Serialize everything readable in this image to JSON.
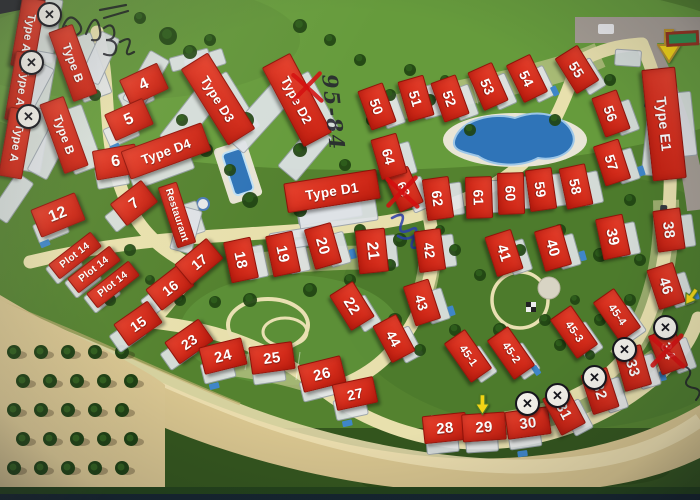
{
  "map": {
    "description": "Aerial resort master plan (photographed print) with numbered plot labels",
    "palette": {
      "label_red": "#d42c1b",
      "label_text": "#ffffff",
      "grass": "#567f36",
      "road_cream": "#e8e0ad",
      "road_gray": "#a59d94",
      "sand": "#d7c48e",
      "pool_blue": "#2f74b8",
      "tree_green": "#1f4312",
      "sign_green": "#2f8f4e",
      "arrow_yellow": "#f2d416",
      "pen_ink": "#14141c",
      "pen_blue": "#2b3fae",
      "pen_red": "#d40f0f"
    },
    "plots": [
      {
        "label": "Type A",
        "kind": "type",
        "x": 27,
        "y": 32,
        "rot": 100,
        "w": 68,
        "h": 22,
        "font": 11.5
      },
      {
        "label": "Type A",
        "kind": "type",
        "x": 21,
        "y": 86,
        "rot": 100,
        "w": 68,
        "h": 22,
        "font": 11.5
      },
      {
        "label": "Type A",
        "kind": "type",
        "x": 15,
        "y": 142,
        "rot": 100,
        "w": 68,
        "h": 22,
        "font": 11.5
      },
      {
        "label": "Type B",
        "kind": "type",
        "x": 72,
        "y": 62,
        "rot": 70,
        "w": 72,
        "h": 24,
        "font": 12
      },
      {
        "label": "Type B",
        "kind": "type",
        "x": 63,
        "y": 134,
        "rot": 70,
        "w": 72,
        "h": 24,
        "font": 12
      },
      {
        "label": "4",
        "kind": "num",
        "x": 143,
        "y": 83,
        "rot": -25,
        "w": 40,
        "h": 27,
        "font": 16
      },
      {
        "label": "5",
        "kind": "num",
        "x": 128,
        "y": 118,
        "rot": -24,
        "w": 40,
        "h": 27,
        "font": 16
      },
      {
        "label": "6",
        "kind": "num",
        "x": 115,
        "y": 161,
        "rot": -10,
        "w": 42,
        "h": 28,
        "font": 16
      },
      {
        "label": "7",
        "kind": "num",
        "x": 133,
        "y": 202,
        "rot": -38,
        "w": 38,
        "h": 26,
        "font": 15
      },
      {
        "label": "12",
        "kind": "num",
        "x": 57,
        "y": 214,
        "rot": -22,
        "w": 46,
        "h": 28,
        "font": 16
      },
      {
        "label": "Plot 14",
        "kind": "special",
        "x": 74,
        "y": 254,
        "rot": -38,
        "w": 52,
        "h": 17,
        "font": 10
      },
      {
        "label": "Plot 14",
        "kind": "special",
        "x": 93,
        "y": 268,
        "rot": -38,
        "w": 52,
        "h": 17,
        "font": 10
      },
      {
        "label": "Plot 14",
        "kind": "special",
        "x": 112,
        "y": 283,
        "rot": -38,
        "w": 52,
        "h": 17,
        "font": 10
      },
      {
        "label": "15",
        "kind": "num",
        "x": 137,
        "y": 322,
        "rot": -35,
        "w": 40,
        "h": 25,
        "font": 14
      },
      {
        "label": "16",
        "kind": "num",
        "x": 169,
        "y": 286,
        "rot": -38,
        "w": 40,
        "h": 25,
        "font": 14
      },
      {
        "label": "17",
        "kind": "num",
        "x": 198,
        "y": 260,
        "rot": -40,
        "w": 40,
        "h": 25,
        "font": 14
      },
      {
        "label": "23",
        "kind": "num",
        "x": 188,
        "y": 340,
        "rot": -35,
        "w": 40,
        "h": 25,
        "font": 14
      },
      {
        "label": "Restaurant",
        "kind": "special",
        "x": 176,
        "y": 214,
        "rot": 72,
        "w": 62,
        "h": 18,
        "font": 10
      },
      {
        "label": "Type D4",
        "kind": "type",
        "x": 165,
        "y": 150,
        "rot": -20,
        "w": 84,
        "h": 28,
        "font": 13
      },
      {
        "label": "Type D3",
        "kind": "type",
        "x": 217,
        "y": 98,
        "rot": 58,
        "w": 88,
        "h": 30,
        "font": 13
      },
      {
        "label": "Type D2",
        "kind": "type",
        "x": 296,
        "y": 99,
        "rot": 62,
        "w": 88,
        "h": 30,
        "font": 13
      },
      {
        "label": "Type D1",
        "kind": "type",
        "x": 331,
        "y": 190,
        "rot": -9,
        "w": 92,
        "h": 28,
        "font": 13.5
      },
      {
        "label": "18",
        "kind": "num",
        "x": 240,
        "y": 259,
        "rot": 78,
        "w": 40,
        "h": 26,
        "font": 15
      },
      {
        "label": "19",
        "kind": "num",
        "x": 282,
        "y": 253,
        "rot": 78,
        "w": 40,
        "h": 26,
        "font": 15
      },
      {
        "label": "20",
        "kind": "num",
        "x": 322,
        "y": 245,
        "rot": 74,
        "w": 40,
        "h": 26,
        "font": 15
      },
      {
        "label": "21",
        "kind": "num",
        "x": 371,
        "y": 250,
        "rot": 84,
        "w": 42,
        "h": 28,
        "font": 16
      },
      {
        "label": "22",
        "kind": "num",
        "x": 351,
        "y": 305,
        "rot": 58,
        "w": 40,
        "h": 26,
        "font": 15
      },
      {
        "label": "24",
        "kind": "num",
        "x": 222,
        "y": 355,
        "rot": -14,
        "w": 42,
        "h": 26,
        "font": 15
      },
      {
        "label": "25",
        "kind": "num",
        "x": 271,
        "y": 357,
        "rot": -8,
        "w": 42,
        "h": 26,
        "font": 15
      },
      {
        "label": "26",
        "kind": "num",
        "x": 321,
        "y": 373,
        "rot": -14,
        "w": 42,
        "h": 26,
        "font": 15
      },
      {
        "label": "27",
        "kind": "num",
        "x": 354,
        "y": 392,
        "rot": -12,
        "w": 40,
        "h": 25,
        "font": 14
      },
      {
        "label": "28",
        "kind": "num",
        "x": 444,
        "y": 427,
        "rot": -6,
        "w": 42,
        "h": 26,
        "font": 15
      },
      {
        "label": "29",
        "kind": "num",
        "x": 483,
        "y": 426,
        "rot": -4,
        "w": 42,
        "h": 26,
        "font": 15
      },
      {
        "label": "30",
        "kind": "num",
        "x": 527,
        "y": 422,
        "rot": -8,
        "w": 42,
        "h": 26,
        "font": 15
      },
      {
        "label": "31",
        "kind": "num",
        "x": 563,
        "y": 410,
        "rot": 62,
        "w": 40,
        "h": 26,
        "font": 15
      },
      {
        "label": "32",
        "kind": "num",
        "x": 599,
        "y": 390,
        "rot": 72,
        "w": 40,
        "h": 26,
        "font": 15
      },
      {
        "label": "33",
        "kind": "num",
        "x": 632,
        "y": 367,
        "rot": 74,
        "w": 40,
        "h": 26,
        "font": 15
      },
      {
        "label": "34",
        "kind": "num",
        "x": 667,
        "y": 350,
        "rot": 70,
        "w": 40,
        "h": 26,
        "font": 15
      },
      {
        "label": "42",
        "kind": "num",
        "x": 429,
        "y": 249,
        "rot": 82,
        "w": 40,
        "h": 25,
        "font": 14
      },
      {
        "label": "43",
        "kind": "num",
        "x": 421,
        "y": 301,
        "rot": 72,
        "w": 40,
        "h": 25,
        "font": 14
      },
      {
        "label": "44",
        "kind": "num",
        "x": 393,
        "y": 337,
        "rot": 62,
        "w": 40,
        "h": 25,
        "font": 14
      },
      {
        "label": "45-1",
        "kind": "num",
        "x": 467,
        "y": 355,
        "rot": 55,
        "w": 46,
        "h": 24,
        "font": 11
      },
      {
        "label": "45-2",
        "kind": "num",
        "x": 510,
        "y": 352,
        "rot": 55,
        "w": 46,
        "h": 24,
        "font": 11
      },
      {
        "label": "45-3",
        "kind": "num",
        "x": 573,
        "y": 331,
        "rot": 55,
        "w": 46,
        "h": 24,
        "font": 11
      },
      {
        "label": "45-4",
        "kind": "num",
        "x": 616,
        "y": 314,
        "rot": 55,
        "w": 46,
        "h": 24,
        "font": 11
      },
      {
        "label": "46",
        "kind": "num",
        "x": 665,
        "y": 285,
        "rot": 72,
        "w": 40,
        "h": 26,
        "font": 15
      },
      {
        "label": "38",
        "kind": "num",
        "x": 668,
        "y": 229,
        "rot": 82,
        "w": 40,
        "h": 26,
        "font": 15
      },
      {
        "label": "39",
        "kind": "num",
        "x": 612,
        "y": 236,
        "rot": 78,
        "w": 40,
        "h": 26,
        "font": 15
      },
      {
        "label": "40",
        "kind": "num",
        "x": 552,
        "y": 247,
        "rot": 74,
        "w": 40,
        "h": 26,
        "font": 15
      },
      {
        "label": "41",
        "kind": "num",
        "x": 503,
        "y": 252,
        "rot": 72,
        "w": 40,
        "h": 26,
        "font": 15
      },
      {
        "label": "50",
        "kind": "num",
        "x": 376,
        "y": 105,
        "rot": 70,
        "w": 40,
        "h": 25,
        "font": 14
      },
      {
        "label": "51",
        "kind": "num",
        "x": 415,
        "y": 97,
        "rot": 74,
        "w": 40,
        "h": 25,
        "font": 14
      },
      {
        "label": "52",
        "kind": "num",
        "x": 449,
        "y": 97,
        "rot": 70,
        "w": 40,
        "h": 25,
        "font": 14
      },
      {
        "label": "53",
        "kind": "num",
        "x": 487,
        "y": 85,
        "rot": 66,
        "w": 40,
        "h": 25,
        "font": 14
      },
      {
        "label": "54",
        "kind": "num",
        "x": 526,
        "y": 77,
        "rot": 64,
        "w": 40,
        "h": 25,
        "font": 14
      },
      {
        "label": "55",
        "kind": "num",
        "x": 576,
        "y": 68,
        "rot": 58,
        "w": 40,
        "h": 25,
        "font": 14
      },
      {
        "label": "56",
        "kind": "num",
        "x": 610,
        "y": 112,
        "rot": 70,
        "w": 40,
        "h": 25,
        "font": 14
      },
      {
        "label": "57",
        "kind": "num",
        "x": 611,
        "y": 161,
        "rot": 72,
        "w": 40,
        "h": 25,
        "font": 14
      },
      {
        "label": "58",
        "kind": "num",
        "x": 575,
        "y": 185,
        "rot": 78,
        "w": 40,
        "h": 25,
        "font": 14
      },
      {
        "label": "59",
        "kind": "num",
        "x": 540,
        "y": 188,
        "rot": 82,
        "w": 40,
        "h": 25,
        "font": 14
      },
      {
        "label": "60",
        "kind": "num",
        "x": 510,
        "y": 192,
        "rot": 88,
        "w": 40,
        "h": 25,
        "font": 14
      },
      {
        "label": "61",
        "kind": "num",
        "x": 478,
        "y": 196,
        "rot": 88,
        "w": 40,
        "h": 25,
        "font": 14
      },
      {
        "label": "62",
        "kind": "num",
        "x": 437,
        "y": 197,
        "rot": 82,
        "w": 40,
        "h": 25,
        "font": 14
      },
      {
        "label": "63",
        "kind": "num",
        "x": 403,
        "y": 188,
        "rot": 66,
        "w": 38,
        "h": 24,
        "font": 13
      },
      {
        "label": "64",
        "kind": "num",
        "x": 388,
        "y": 155,
        "rot": 74,
        "w": 40,
        "h": 25,
        "font": 14
      },
      {
        "label": "Type E1",
        "kind": "type",
        "x": 663,
        "y": 123,
        "rot": 84,
        "w": 110,
        "h": 32,
        "font": 14
      }
    ],
    "x_circle_badges": [
      {
        "x": 49,
        "y": 14
      },
      {
        "x": 31,
        "y": 62
      },
      {
        "x": 28,
        "y": 116
      },
      {
        "x": 527,
        "y": 403
      },
      {
        "x": 557,
        "y": 395
      },
      {
        "x": 594,
        "y": 377
      },
      {
        "x": 624,
        "y": 349
      },
      {
        "x": 665,
        "y": 327
      }
    ],
    "red_x_marks": [
      {
        "x": 307,
        "y": 87,
        "size": 34
      },
      {
        "x": 402,
        "y": 192,
        "size": 36
      },
      {
        "x": 667,
        "y": 351,
        "size": 38
      }
    ],
    "arrows": [
      {
        "x": 669,
        "y": 46,
        "rot": 0,
        "scale": 1.0,
        "outline": "#b8912a"
      },
      {
        "x": 482,
        "y": 405,
        "rot": 0,
        "scale": 0.62,
        "outline": "#4f7a23"
      },
      {
        "x": 691,
        "y": 297,
        "rot": 35,
        "scale": 0.58,
        "outline": "#4f7a23"
      }
    ],
    "handwriting": {
      "route_note": {
        "text": "95-84"
      },
      "scribbles": [
        "top-left-pen-scribble",
        "blue-pen-scribble",
        "right-edge-pen-scribble"
      ]
    },
    "x_badge_glyph": "✕"
  }
}
